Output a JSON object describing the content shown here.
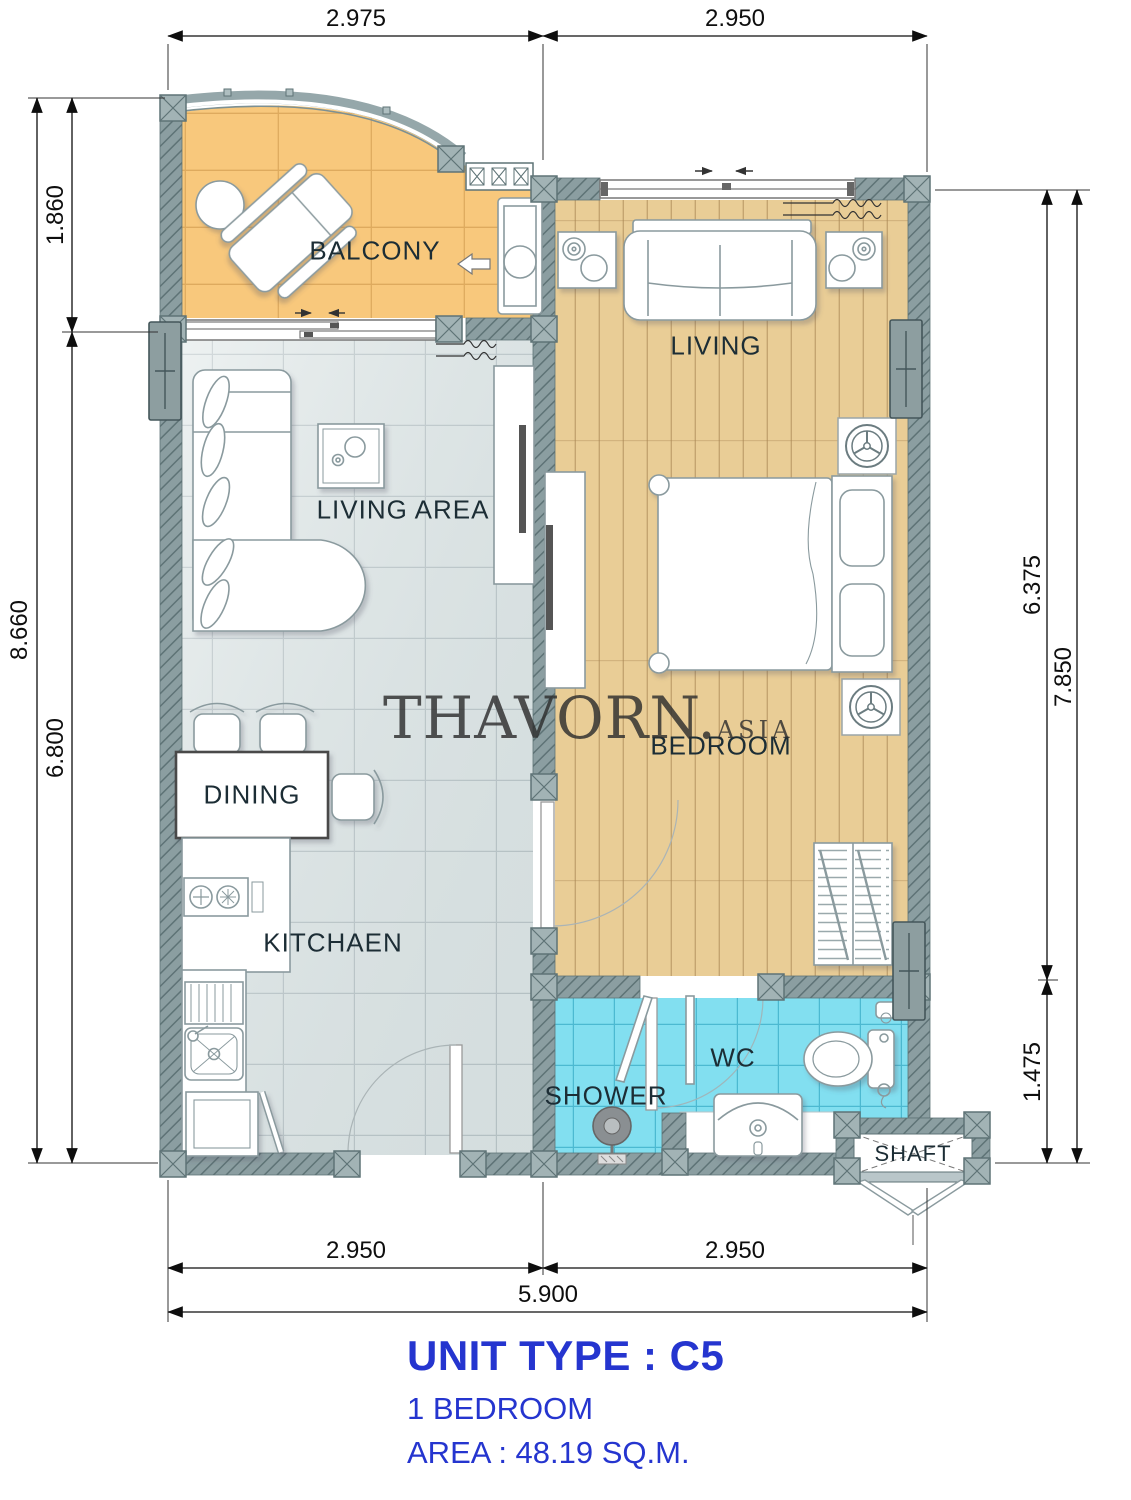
{
  "title": {
    "unit_type": "UNIT TYPE : C5",
    "bedrooms": "1 BEDROOM",
    "area": "AREA  : 48.19  SQ.M."
  },
  "watermark": {
    "brand": "THAVORN.",
    "tld": "ASIA"
  },
  "rooms": {
    "balcony": "BALCONY",
    "living": "LIVING",
    "living_area": "LIVING AREA",
    "dining": "DINING",
    "kitchen": "KITCHAEN",
    "bedroom": "BEDROOM",
    "shower": "SHOWER",
    "wc": "WC",
    "shaft": "SHAFT"
  },
  "dimensions": {
    "top": [
      "2.975",
      "2.950"
    ],
    "left": {
      "outer": "8.660",
      "inner_top": "1.860",
      "inner_bottom": "6.800"
    },
    "right": {
      "outer": "7.850",
      "inner_top": "6.375",
      "inner_bottom": "1.475"
    },
    "bottom": {
      "inner": [
        "2.950",
        "2.950"
      ],
      "outer": "5.900"
    }
  },
  "colors": {
    "accent_blue": "#2535cf",
    "wall": "#8b9ea1",
    "balcony_floor": "#f8c87c",
    "wood_floor": "#e9cd96",
    "tile_floor": "#e2e9e9",
    "bath_floor": "#82dff0",
    "label_text": "#1c2d35"
  }
}
